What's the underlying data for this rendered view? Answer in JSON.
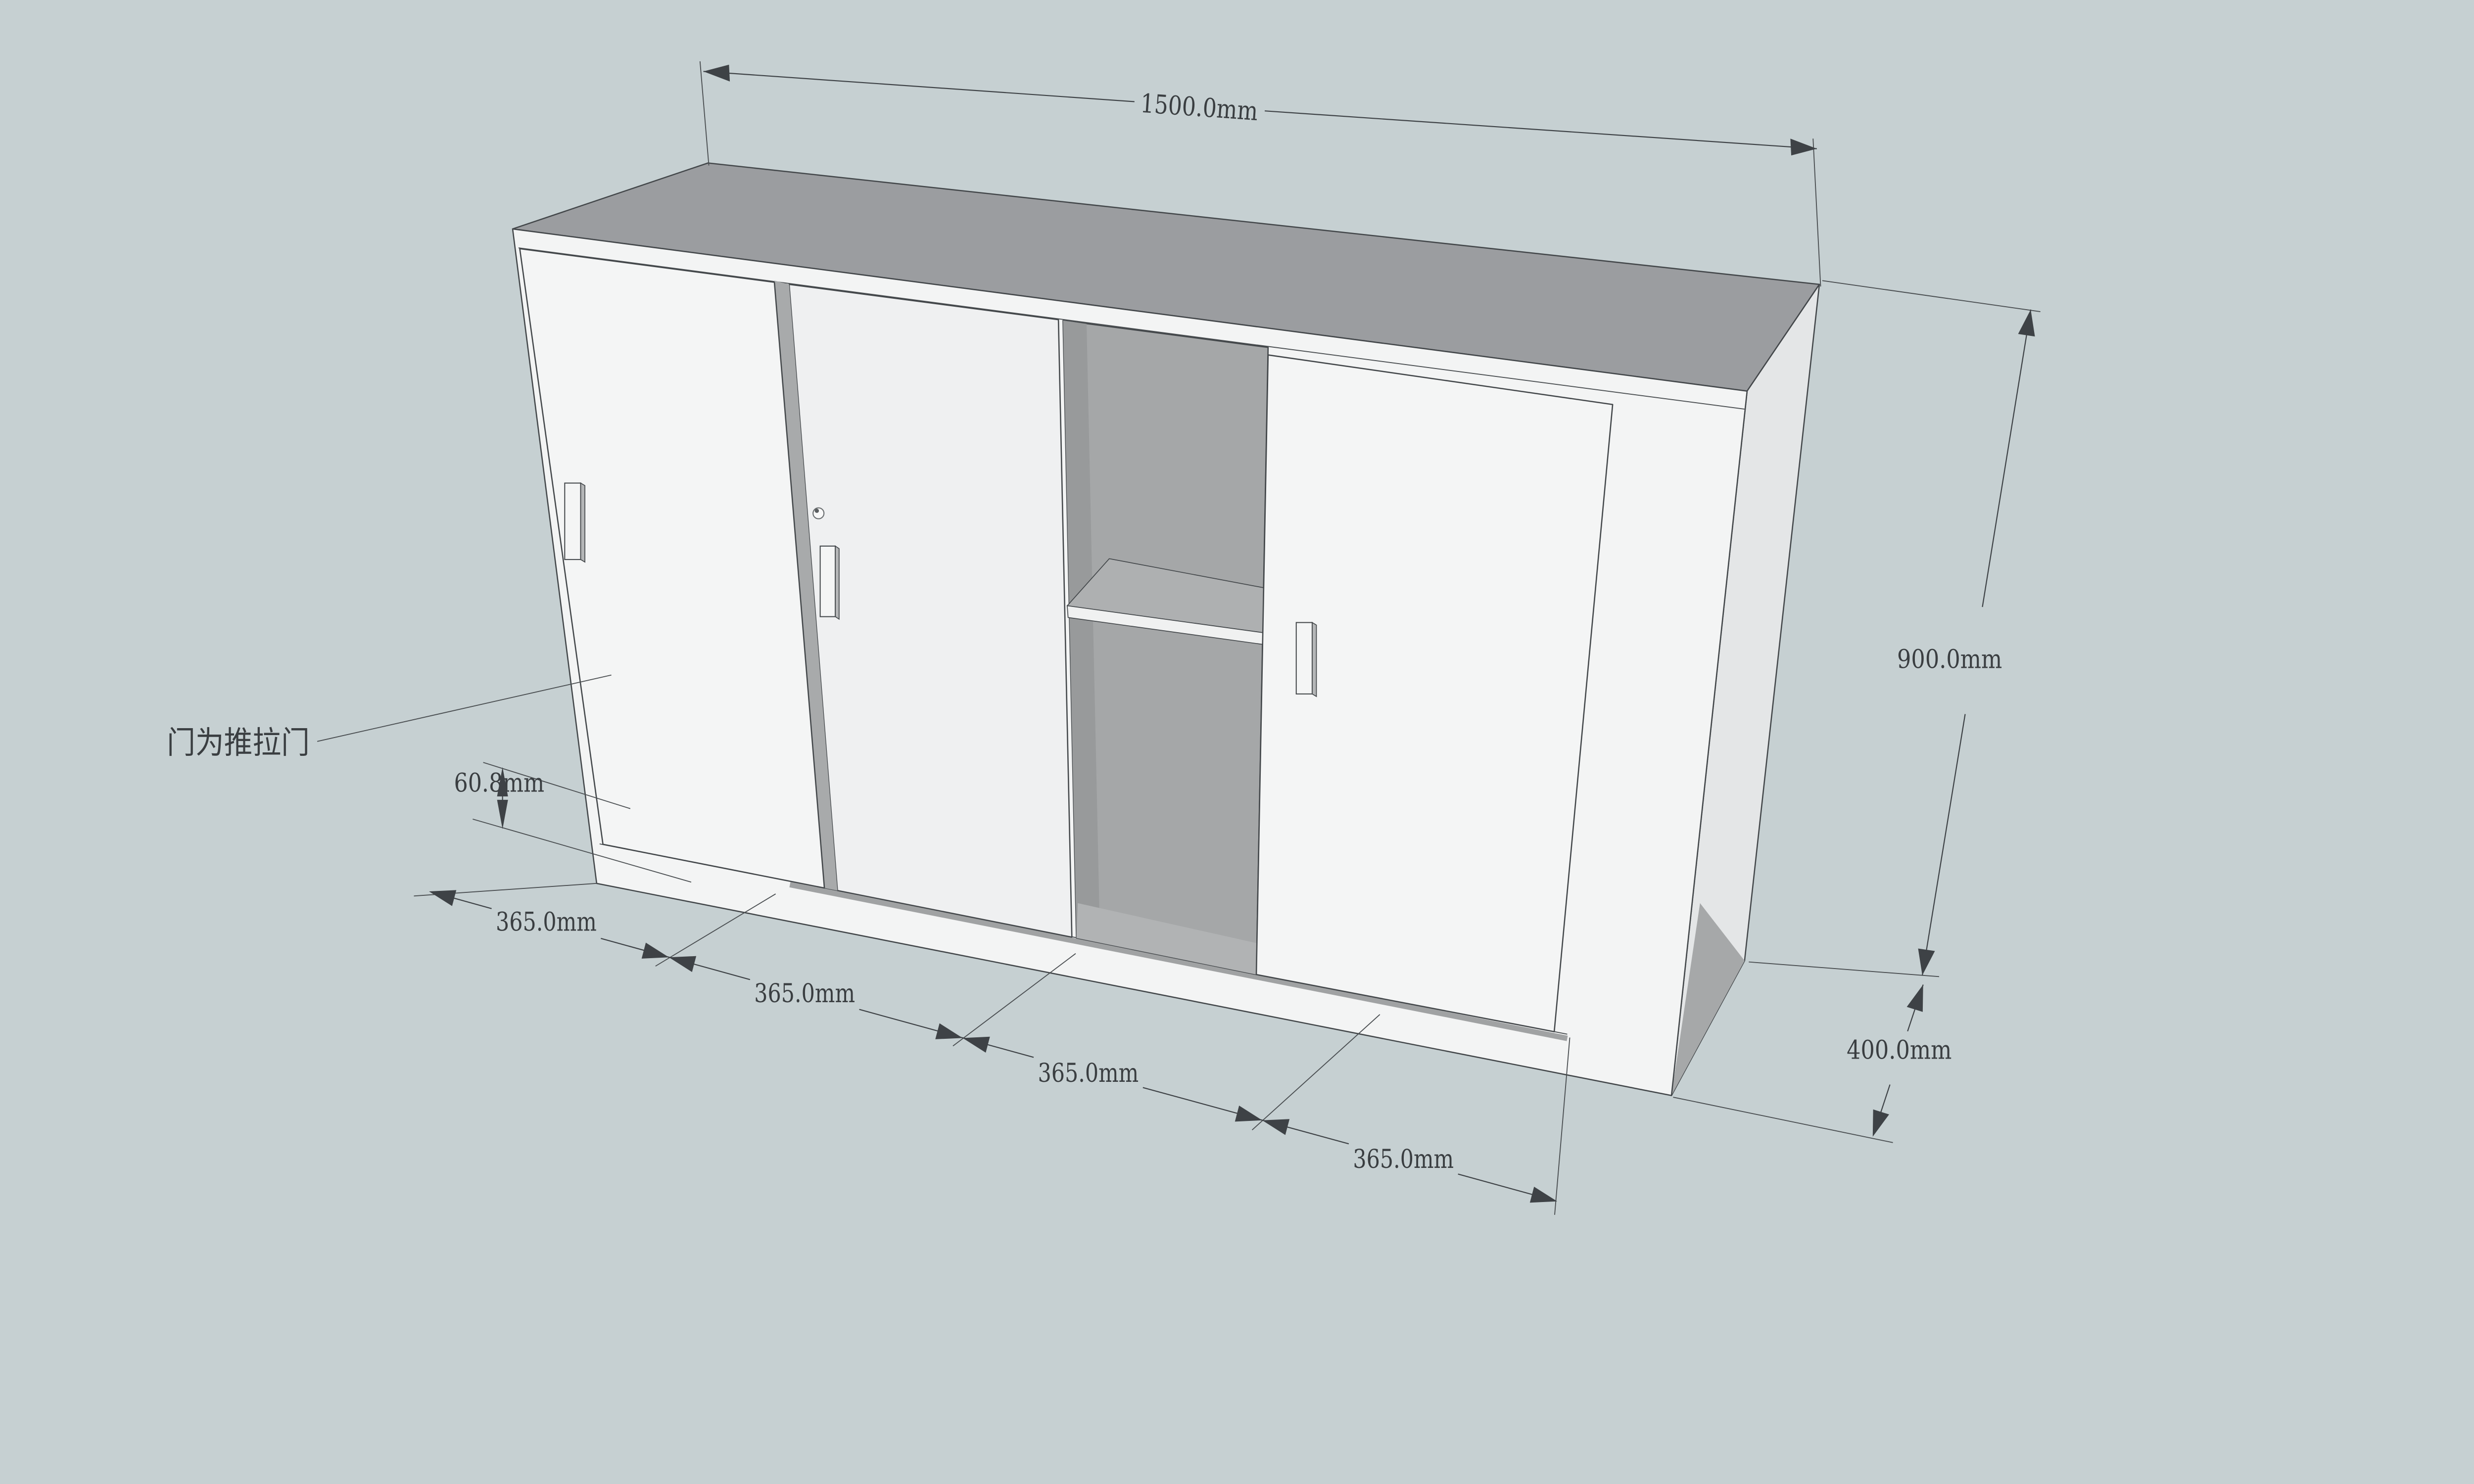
{
  "scene": {
    "background_color": "#c6d0d2",
    "type_note": "SketchUp-style dimensioned cabinet drawing"
  },
  "dimensions": {
    "width": {
      "label": "1500.0mm"
    },
    "height": {
      "label": "900.0mm"
    },
    "depth": {
      "label": "400.0mm"
    },
    "base_height": {
      "label": "60.8mm"
    },
    "sections": [
      {
        "label": "365.0mm"
      },
      {
        "label": "365.0mm"
      },
      {
        "label": "365.0mm"
      },
      {
        "label": "365.0mm"
      }
    ]
  },
  "annotation": {
    "door_note": "门为推拉门"
  },
  "colors": {
    "background": "#c6d0d2",
    "top_face": "#9b9da0",
    "front_face": "#f3f4f4",
    "side_face": "#e4e6e7",
    "side_face_shadow": "#a6a8a9",
    "interior": "#a5a7a8",
    "line": "#3e4246"
  }
}
